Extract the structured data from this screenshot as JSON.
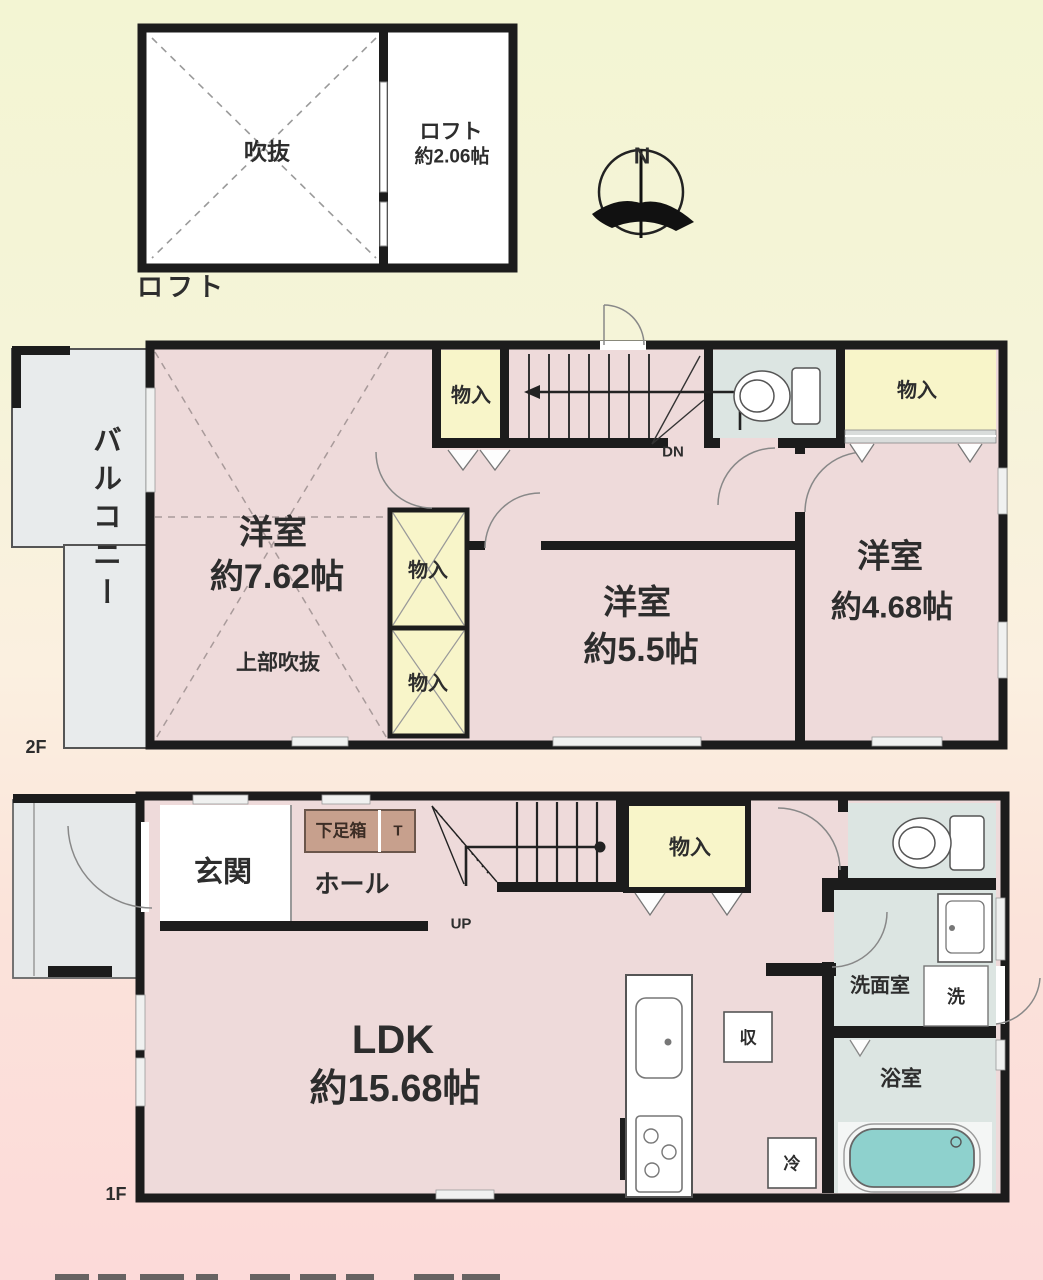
{
  "colors": {
    "wall": "#1c1c1c",
    "room_pink": "#eedada",
    "closet_yellow": "#f8f5c9",
    "wet_gray": "#dce5e2",
    "balcony_gray": "#e8ebec",
    "tub_teal": "#8ed1cd",
    "shoe_cabinet_brown": "#c7a08d",
    "bg_top": "#f3f5d3",
    "bg_bottom": "#fcdad9"
  },
  "loft": {
    "void_label": "吹抜",
    "room_name": "ロフト",
    "room_size": "約2.06帖",
    "caption": "ロフト"
  },
  "compass": {
    "north": "N"
  },
  "floor2": {
    "floor_label": "2F",
    "balcony_label": "バルコニー",
    "closet_label": "物入",
    "stairs_label": "DN",
    "room_west": {
      "name": "洋室",
      "size": "約7.62帖",
      "note": "上部吹抜"
    },
    "room_center": {
      "name": "洋室",
      "size": "約5.5帖"
    },
    "room_east": {
      "name": "洋室",
      "size": "約4.68帖"
    }
  },
  "floor1": {
    "floor_label": "1F",
    "entrance_label": "玄関",
    "hall_label": "ホール",
    "shoe_cabinet_label": "下足箱",
    "shoe_cabinet_side": "T",
    "stairs_label": "UP",
    "closet_label": "物入",
    "ldk": {
      "name": "LDK",
      "size": "約15.68帖"
    },
    "washroom_label": "洗面室",
    "washer_label": "洗",
    "bathroom_label": "浴室",
    "storage_label": "収",
    "fridge_label": "冷"
  }
}
